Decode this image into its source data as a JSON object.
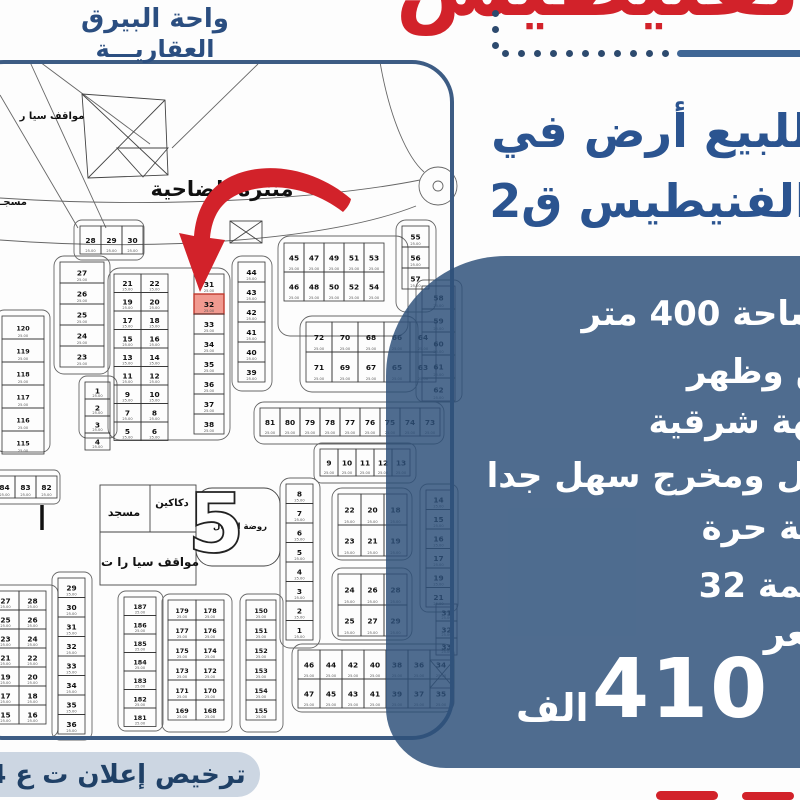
{
  "brand": {
    "name_line1": "واحة البيرق",
    "name_line2": "العقاريـــة"
  },
  "header": {
    "red_title": "الفنيطيس",
    "sale_line1": "للبيع أرض في",
    "sale_line2": "الفنيطيس ق2"
  },
  "panel": {
    "overlay_color": "rgba(45,80,122,0.84)",
    "features": [
      "المساحة 400 متر",
      "بطن وظهر",
      "واجهة شرقية",
      "مدخل ومخرج سهل جدا",
      "وثيقة حرة",
      "قسيمة 32"
    ],
    "price_label": "السعر",
    "price_value": "410",
    "price_unit": "الف"
  },
  "footer": {
    "license": "ترخيص إعلان ت ع 64"
  },
  "colors": {
    "red": "#d2222a",
    "blue_title": "#2b5490",
    "frame_blue": "#3d5c84",
    "highlight_plot_fill": "#f19a90",
    "pill_bg": "#ccd6e2"
  },
  "map": {
    "park_label": "منتزة الضاحية",
    "parking_label_top": "مواقف سيا ر",
    "mosque_edge_label": "مسجـ",
    "mosque_label": "مسجد",
    "shops_label": "دكاكين",
    "car_park_label": "مواقف سيا را ت",
    "kindergarten_label": "روضة اطفال",
    "big_digit": "5",
    "dim_label": "25.00",
    "highlight_plot": "32",
    "blocks": [
      {
        "x": 80,
        "y": 226,
        "cols": 3,
        "rows": 1,
        "cw": 21,
        "ch": 28,
        "nums": [
          "28",
          "29",
          "30"
        ]
      },
      {
        "x": 60,
        "y": 262,
        "cols": 1,
        "rows": 5,
        "cw": 44,
        "ch": 21,
        "nums": [
          "27",
          "26",
          "25",
          "24",
          "23"
        ]
      },
      {
        "x": 114,
        "y": 274,
        "cols": 2,
        "rows": 9,
        "cw": 27,
        "ch": 18.5,
        "nums": [
          "21",
          "22",
          "19",
          "20",
          "17",
          "18",
          "15",
          "16",
          "13",
          "14",
          "11",
          "12",
          "9",
          "10",
          "7",
          "8",
          "5",
          "6"
        ]
      },
      {
        "x": 194,
        "y": 274,
        "cols": 1,
        "rows": 8,
        "cw": 30,
        "ch": 20,
        "nums": [
          "31",
          "32",
          "33",
          "34",
          "35",
          "36",
          "37",
          "38"
        ],
        "highlight": 1
      },
      {
        "x": 2,
        "y": 316,
        "cols": 1,
        "rows": 6,
        "cw": 42,
        "ch": 23,
        "nums": [
          "120",
          "119",
          "118",
          "117",
          "116",
          "115"
        ]
      },
      {
        "x": 238,
        "y": 262,
        "cols": 1,
        "rows": 6,
        "cw": 27,
        "ch": 20,
        "nums": [
          "44",
          "43",
          "42",
          "41",
          "40",
          "39"
        ]
      },
      {
        "x": 284,
        "y": 243,
        "cols": 5,
        "rows": 2,
        "cw": 20,
        "ch": 29,
        "nums": [
          "45",
          "47",
          "49",
          "51",
          "53",
          "46",
          "48",
          "50",
          "52",
          "54"
        ]
      },
      {
        "x": 402,
        "y": 226,
        "cols": 1,
        "rows": 3,
        "cw": 27,
        "ch": 21,
        "nums": [
          "55",
          "56",
          "57"
        ]
      },
      {
        "x": 306,
        "y": 322,
        "cols": 5,
        "rows": 2,
        "cw": 26,
        "ch": 30,
        "nums": [
          "72",
          "70",
          "68",
          "66",
          "64",
          "71",
          "69",
          "67",
          "65",
          "63"
        ]
      },
      {
        "x": 422,
        "y": 286,
        "cols": 1,
        "rows": 5,
        "cw": 33,
        "ch": 23,
        "nums": [
          "58",
          "59",
          "60",
          "61",
          "62"
        ]
      },
      {
        "x": 260,
        "y": 408,
        "cols": 9,
        "rows": 1,
        "cw": 20,
        "ch": 28,
        "nums": [
          "81",
          "80",
          "79",
          "78",
          "77",
          "76",
          "75",
          "74",
          "73"
        ]
      },
      {
        "x": 85,
        "y": 382,
        "cols": 1,
        "rows": 4,
        "cw": 25,
        "ch": 17,
        "nums": [
          "1",
          "2",
          "3",
          "4"
        ]
      },
      {
        "x": 286,
        "y": 484,
        "cols": 1,
        "rows": 8,
        "cw": 27,
        "ch": 19.5,
        "nums": [
          "8",
          "7",
          "6",
          "5",
          "4",
          "3",
          "2",
          "1"
        ]
      },
      {
        "x": 320,
        "y": 449,
        "cols": 5,
        "rows": 1,
        "cw": 18,
        "ch": 27,
        "nums": [
          "9",
          "10",
          "11",
          "12",
          "13"
        ]
      },
      {
        "x": 338,
        "y": 494,
        "cols": 3,
        "rows": 2,
        "cw": 23,
        "ch": 31,
        "nums": [
          "22",
          "20",
          "18",
          "23",
          "21",
          "19"
        ]
      },
      {
        "x": 338,
        "y": 574,
        "cols": 3,
        "rows": 2,
        "cw": 23,
        "ch": 31,
        "nums": [
          "24",
          "26",
          "28",
          "25",
          "27",
          "29"
        ]
      },
      {
        "x": 426,
        "y": 490,
        "cols": 1,
        "rows": 6,
        "cw": 25,
        "ch": 19.5,
        "nums": [
          "14",
          "15",
          "16",
          "17",
          "19",
          "21"
        ]
      },
      {
        "x": 436,
        "y": 604,
        "cols": 1,
        "rows": 3,
        "cw": 21,
        "ch": 17,
        "nums": [
          "31",
          "32",
          "33"
        ]
      },
      {
        "x": -8,
        "y": 591,
        "cols": 2,
        "rows": 7,
        "cw": 27,
        "ch": 19,
        "nums": [
          "27",
          "28",
          "25",
          "26",
          "23",
          "24",
          "21",
          "22",
          "19",
          "20",
          "17",
          "18",
          "15",
          "16"
        ]
      },
      {
        "x": 58,
        "y": 578,
        "cols": 1,
        "rows": 8,
        "cw": 27,
        "ch": 19.5,
        "nums": [
          "29",
          "30",
          "31",
          "32",
          "33",
          "34",
          "35",
          "36"
        ]
      },
      {
        "x": 124,
        "y": 597,
        "cols": 1,
        "rows": 7,
        "cw": 32,
        "ch": 18.5,
        "nums": [
          "187",
          "186",
          "185",
          "184",
          "183",
          "182",
          "181"
        ]
      },
      {
        "x": 168,
        "y": 600,
        "cols": 2,
        "rows": 6,
        "cw": 28,
        "ch": 20,
        "nums": [
          "179",
          "178",
          "177",
          "176",
          "175",
          "174",
          "173",
          "172",
          "171",
          "170",
          "169",
          "168"
        ]
      },
      {
        "x": 246,
        "y": 600,
        "cols": 1,
        "rows": 6,
        "cw": 30,
        "ch": 20,
        "nums": [
          "150",
          "151",
          "152",
          "153",
          "154",
          "155"
        ]
      },
      {
        "x": 298,
        "y": 650,
        "cols": 7,
        "rows": 2,
        "cw": 22,
        "ch": 29,
        "nums": [
          "46",
          "44",
          "42",
          "40",
          "38",
          "36",
          "34",
          "47",
          "45",
          "43",
          "41",
          "39",
          "37",
          "35"
        ]
      },
      {
        "x": -6,
        "y": 476,
        "cols": 3,
        "rows": 1,
        "cw": 21,
        "ch": 22,
        "nums": [
          "84",
          "83",
          "82"
        ]
      }
    ]
  }
}
